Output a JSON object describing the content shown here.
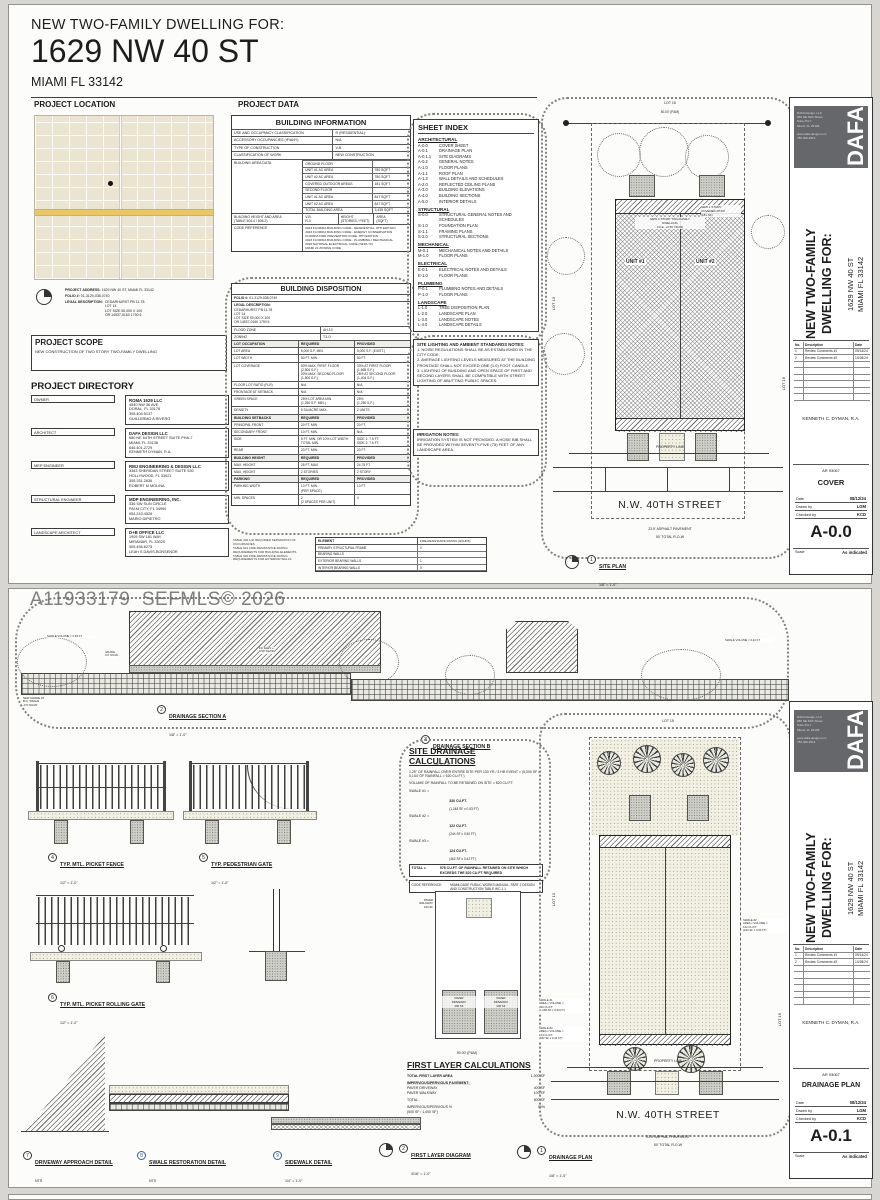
{
  "watermark": "A11933179  SEFMLS© 2026",
  "page1": {
    "header": {
      "small": "NEW TWO-FAMILY DWELLING FOR:",
      "big": "1629 NW 40 ST",
      "city": "MIAMI FL 33142"
    },
    "section_location": "PROJECT LOCATION",
    "section_data": "PROJECT DATA",
    "map_notes": {
      "address_label": "PROJECT ADDRESS:",
      "address": "1629 NW 40 ST, MIAMI FL 33142",
      "folio_label": "FOLIO #:",
      "folio": "01-3129-038-0740",
      "legal_label": "LEGAL DESCRIPTION:",
      "legal": "CEDARHURST PB 11-78\nLOT 14\nLOT SIZE 50.000 X 100\nOR 14937-0160 1790 5"
    },
    "scope": {
      "title": "PROJECT SCOPE",
      "text": "NEW CONSTRUCTION OF TWO STORY TWO-FAMILY DWELLING"
    },
    "directory_title": "PROJECT DIRECTORY",
    "directory": [
      {
        "role": "OWNER",
        "name": "ROMA 1629 LLC",
        "info": "4540 NW 36 AVE\nDORAL, FL 33178\n305.404.5137\nGUILLERMO A RIVERO"
      },
      {
        "role": "ARCHITECT",
        "name": "DAFA DESIGN LLC",
        "info": "680 NE 64TH STREET SUITE PHA-7\nMIAMI, FL 33138\n646.401.2729\nKENNETH DYMAN, R.A."
      },
      {
        "role": "MEP ENGINEER",
        "name": "RMJ ENGINEERING & DESIGN LLC",
        "info": "3363 SHERIDAN STREET SUITE 530\nHOLLYWOOD, FL 33021\n305.331.2636\nROBERT M MOLINA"
      },
      {
        "role": "STRUCTURAL ENGINEER",
        "name": "MDP ENGINEERING, INC.",
        "info": "336 SW SUN CIRCLE\nPALM CITY, FL 34990\n954.243.4526\nMARIO DIPIETRO"
      },
      {
        "role": "LANDSCAPE ARCHITECT",
        "name": "D+B OFFICE LLC",
        "info": "1905 SW 181 WAY\nMIRAMAR, FL 33029\n305.456.6275\nLEAH S DAVIS-BONSENOR"
      }
    ],
    "building_info": {
      "title": "BUILDING INFORMATION",
      "rows": [
        {
          "label": "USE AND OCCUPANCY CLASSIFICATION",
          "value": "R (RESIDENTIAL)"
        },
        {
          "label": "ACCESSORY OCCUPANCIES (IF/ANY)",
          "value": "N/A"
        },
        {
          "label": "TYPE OF CONSTRUCTION",
          "value": "V-B"
        },
        {
          "label": "CLASSIFICATION OF WORK",
          "value": "NEW CONSTRUCTION"
        }
      ],
      "area_label": "BUILDING AREA DATA",
      "area_rows": [
        {
          "name": "GROUND FLOOR",
          "sqft": ""
        },
        {
          "name": "UNIT #1 AC AREA",
          "sqft": "780 SQFT"
        },
        {
          "name": "UNIT #2 AC AREA",
          "sqft": "780 SQFT"
        },
        {
          "name": "COVERED OUTDOOR AREAS",
          "sqft": "181 SQFT"
        },
        {
          "name": "SECOND FLOOR",
          "sqft": ""
        },
        {
          "name": "UNIT #1 AC AREA",
          "sqft": "847 SQFT"
        },
        {
          "name": "UNIT #2 AC AREA",
          "sqft": "847 SQFT"
        },
        {
          "name": "TOTAL BUILDING AREA",
          "sqft": "3,435 SQFT"
        }
      ],
      "height_row": {
        "label": "BUILDING HEIGHT AND AREA\n(TABLE 504.4 / 506.2)",
        "c1": "V-B\nR-3",
        "c2": "HEIGHT\n(STORIES / FEET)",
        "c3": "AREA\n(SQFT)"
      },
      "code_row": {
        "label": "CODE REFERENCE",
        "value": "2023 FLORIDA BUILDING CODE - RESIDENTIAL, 8TH EDITION\n2023 FLORIDA BUILDING CODE - ENERGY CONSERVATION\nFLORIDA FIRE PREVENTION CODE, 8TH EDITION\n2023 FLORIDA BUILDING CODE - PLUMBING / MECHANICAL\n2020 NATIONAL ELECTRICAL CODE (NFPA 70)\nMIAMI 21 ZONING CODE"
      }
    },
    "fire_notes": "TABLE 302.1(1) REQUIRED SEPARATION OF OCCUPANCIES\nTABLE 601 FIRE-RESISTANCE RATING REQUIREMENTS FOR BUILDING ELEMENTS\nTABLE 602 FIRE-RESISTANCE RATING REQUIREMENTS FOR EXTERIOR WALLS",
    "fire_table": {
      "title": "ELEMENT",
      "col": "FIRE-RESISTANCE RATING (HOURS)",
      "rows": [
        [
          "PRIMARY STRUCTURAL FRAME",
          "0"
        ],
        [
          "BEARING WALLS",
          ""
        ],
        [
          "EXTERIOR BEARING WALLS",
          "1"
        ],
        [
          "INTERIOR BEARING WALLS",
          "0"
        ]
      ]
    },
    "disposition": {
      "title": "BUILDING DISPOSITION",
      "folio_label": "FOLIO #:",
      "folio": "01-3129-038-0740",
      "legal_label": "LEGAL DESCRIPTION:",
      "legal": "CEDARHURST PB 11-78\nLOT 14\nLOT SIZE 50.000 X 100\nOR 14937-0160 1790 5",
      "flood_label": "FLOOD ZONE",
      "flood": "AH-10",
      "zoning_label": "ZONING",
      "zoning": "T3-O",
      "occ_header": {
        "a": "LOT OCCUPATION",
        "b": "REQUIRED",
        "c": "PROVIDED"
      },
      "occ_rows": [
        {
          "a": "LOT AREA",
          "b": "5,000 S.F. MIN.",
          "c": "5,000 S.F. (EXIST.)"
        },
        {
          "a": "LOT WIDTH",
          "b": "50 FT. MIN.",
          "c": "50 FT."
        },
        {
          "a": "LOT COVERAGE",
          "b": "50% MAX. FIRST FLOOR\n(2,500 S.F.)\n30% MAX. SECOND FLOOR\n(1,500 S.F.)",
          "c": "33% AT FIRST FLOOR\n(1,665 S.F.)\n28% AT SECOND FLOOR\n(1,404 S.F.)"
        },
        {
          "a": "FLOOR LOT RATIO (FLR)",
          "b": "N/A",
          "c": "N/A"
        },
        {
          "a": "FRONTAGE AT SETBACK",
          "b": "N/A",
          "c": "N/A"
        },
        {
          "a": "GREEN SPACE",
          "b": "25% LOT AREA MIN.\n(1,250 S.F. MIN.)",
          "c": "25%\n(1,250 S.F.)"
        },
        {
          "a": "DENSITY",
          "b": "9 DU/ACRE MAX.",
          "c": "2 UNITS"
        }
      ],
      "set_header": {
        "a": "BUILDING SETBACKS",
        "b": "REQUIRED",
        "c": "PROVIDED"
      },
      "set_rows": [
        {
          "a": "PRINCIPAL FRONT",
          "b": "20 FT. MIN.",
          "c": "20 FT."
        },
        {
          "a": "SECONDARY FRONT",
          "b": "10 FT. MIN.",
          "c": "N/A"
        },
        {
          "a": "SIDE",
          "b": "5 FT. MIN. OR 10% LOT WIDTH\nTOTAL MIN.",
          "c": "SIDE 1: 7.5 FT.\nSIDE 2: 7.5 FT."
        },
        {
          "a": "REAR",
          "b": "20 FT. MIN.",
          "c": "20 FT."
        }
      ],
      "hgt_header": {
        "a": "BUILDING HEIGHT",
        "b": "REQUIRED",
        "c": "PROVIDED"
      },
      "hgt_rows": [
        {
          "a": "MAX. HEIGHT",
          "b": "25 FT. MAX.",
          "c": "24.75 FT."
        },
        {
          "a": "MAX. HEIGHT",
          "b": "2 STORIES",
          "c": "2 STORY"
        }
      ],
      "park_header": {
        "a": "PARKING",
        "b": "REQUIRED",
        "c": "PROVIDED"
      },
      "park_rows": [
        {
          "a": "PARKING WIDTH",
          "b": "10 FT. MIN.\n(PER SPACE)",
          "c": "10 FT."
        },
        {
          "a": "MIN. SPACES",
          "b": "2\n(2 SPACES PER UNIT)",
          "c": "4"
        }
      ]
    },
    "sheet_index": {
      "title": "SHEET INDEX",
      "arch_label": "ARCHITECTURAL",
      "arch": [
        [
          "A-0.0",
          "COVER SHEET"
        ],
        [
          "A-0.1",
          "DRAINAGE PLAN"
        ],
        [
          "A-0.1.1",
          "SITE DIAGRAMS"
        ],
        [
          "A-0.2",
          "GENERAL NOTES"
        ],
        [
          "A-1.0",
          "FLOOR PLANS"
        ],
        [
          "A-1.1",
          "ROOF PLAN"
        ],
        [
          "A-1.2",
          "WALL DETAILS AND SCHEDULES"
        ],
        [
          "A-2.0",
          "REFLECTED CEILING PLANS"
        ],
        [
          "A-3.0",
          "BUILDING ELEVATIONS"
        ],
        [
          "A-4.0",
          "BUILDING SECTIONS"
        ],
        [
          "A-5.0",
          "INTERIOR DETAILS"
        ]
      ],
      "str_label": "STRUCTURAL",
      "str": [
        [
          "S-0.0",
          "STRUCTURAL GENERAL NOTES AND SCHEDULES"
        ],
        [
          "S-1.0",
          "FOUNDATION PLAN"
        ],
        [
          "S-1.1",
          "FRAMING PLANS"
        ],
        [
          "S-2.0",
          "STRUCTURAL SECTIONS"
        ]
      ],
      "mec_label": "MECHANICAL",
      "mec": [
        [
          "M-0.1",
          "MECHANICAL NOTES AND DETAILS"
        ],
        [
          "M-1.0",
          "FLOOR PLANS"
        ]
      ],
      "ele_label": "ELECTRICAL",
      "ele": [
        [
          "E-0.1",
          "ELECTRICAL NOTES AND DETAILS"
        ],
        [
          "E-1.0",
          "FLOOR PLANS"
        ]
      ],
      "plu_label": "PLUMBING",
      "plu": [
        [
          "P-0.1",
          "PLUMBING NOTES AND DETAILS"
        ],
        [
          "P-1.0",
          "FLOOR PLANS"
        ]
      ],
      "lan_label": "LANDSCAPE",
      "lan": [
        [
          "L-1.0",
          "TREE DISPOSITION PLAN"
        ],
        [
          "L-2.0",
          "LANDSCAPE PLAN"
        ],
        [
          "L-3.0",
          "LANDSCAPE NOTES"
        ],
        [
          "L-4.0",
          "LANDSCAPE DETAILS"
        ]
      ]
    },
    "lighting": {
      "title": "SITE LIGHTING AND AMBIENT STANDARDS NOTES:",
      "body": "1. NOISE REGULATIONS SHALL BE AS ESTABLISHED IN THE CITY CODE.\n2. AVERAGE LIGHTING LEVELS MEASURED AT THE BUILDING FRONTAGE SHALL NOT EXCEED ONE (1.0) FOOT CANDLE.\n3. LIGHTING OF BUILDING AND OPEN SPACE OF FIRST AND SECOND LAYERS SHALL BE COMPATIBLE WITH STREET LIGHTING OF ABUTTING PUBLIC SPACES."
    },
    "irrigation": {
      "title": "IRRIGATION NOTES:",
      "body": "IRRIGATION SYSTEM IS NOT PROVIDED. A HOSE BIB SHALL BE PROVIDED WITHIN SEVENTY-FIVE (75) FEET OF ANY LANDSCAPE AREA."
    },
    "site_plan": {
      "lot_top": "LOT 15",
      "lot_left": "LOT 13",
      "lot_right": "LOT 16",
      "dim_top": "50.00' (P&M)",
      "unit1": "UNIT #1",
      "unit2": "UNIT #2",
      "center_note": "NEW 2 STORY TWO-FAMILY\nDWELLING\nF.F.E. +0.50' NGVD",
      "patio_note": "NEW 1 STORY\nCOVERED PATIO\n(181 SF)",
      "property_line": "PROPERTY LINE",
      "street": "N.W. 40TH STREET",
      "pavement": "23.5' ASPHALT PAVEMENT",
      "row": "50' TOTAL R-O-W",
      "detail_num": "1",
      "detail_name": "SITE PLAN",
      "detail_scale": "1/8\" = 1'-0\""
    },
    "titleblock": {
      "firm": "DAFA Design, LLC\n680 NE 64th Street\nSuite PH-7\nMiami, FL 33138\n\nwww.dafa-design.com\n786.409.2513",
      "logo": "DAFA",
      "proj_line1": "NEW TWO-FAMILY",
      "proj_line2": "DWELLING FOR:",
      "addr_line1": "1629 NW 40 ST",
      "addr_line2": "MIAMI FL 33142",
      "rev_no": "No.",
      "rev_desc": "Description",
      "rev_date": "Date",
      "revisions": [
        {
          "no": "1",
          "desc": "Review Comments #1",
          "date": "09/14/24"
        },
        {
          "no": "2",
          "desc": "Review Comments #2",
          "date": "10/28/24"
        }
      ],
      "architect": "KENNETH C. DYMAN, R.A.",
      "license": "AR 93067",
      "sheet_title": "COVER",
      "date_label": "Date",
      "date": "08/12/24",
      "drawn_label": "Drawn by",
      "drawn": "LGM",
      "checked_label": "Checked by",
      "checked": "KCD",
      "sheet_num": "A-0.0",
      "scale_label": "Scale",
      "scale": "As indicated"
    }
  },
  "page2": {
    "sections": {
      "a_num": "2",
      "a_name": "DRAINAGE SECTION A",
      "a_scale": "1/8\" = 1'-0\"",
      "b_num": "3",
      "b_name": "DRAINAGE SECTION B",
      "b_scale": "1/8\" = 1'-0\"",
      "c1": "SWALE VOLUME = 0.53 FT",
      "c2": "GRADE\n0.0' NGVD",
      "c3": "F.F. ELEV +\n0.50' NGVD",
      "c4": "NEW GRADE AT\nB.O. SWALE\n-0.5' NGVD",
      "c5": "SWALE VOLUME = 0.42 FT"
    },
    "fence": {
      "num": "4",
      "name": "TYP. MTL. PICKET FENCE",
      "scale": "1/2\" = 1'-0\""
    },
    "gate": {
      "num": "5",
      "name": "TYP. PEDESTRIAN GATE",
      "scale": "1/2\" = 1'-0\""
    },
    "rolling": {
      "num": "6",
      "name": "TYP. MTL. PICKET ROLLING GATE",
      "scale": "1/2\" = 1'-0\""
    },
    "drainage_calc": {
      "title": "SITE DRAINAGE CALCULATIONS",
      "intro": "1.25\" OF RAINFALL OVER ENTIRE SITE PER 100 YR / 3 HR EVENT = (5,000 SF x 0.104' OF RAINFALL = 520 CU.FT.)",
      "volume": "VOLUME OF RAINFALL TO BE RETAINED ON SITE = 520 CU.FT.",
      "rows": [
        {
          "label": "SWALE #1 =",
          "v": "330 CU.FT.",
          "sub": "(1,248 SF x 0.53 FT)"
        },
        {
          "label": "SWALE #2 =",
          "v": "122 CU.FT.",
          "sub": "(244 SF x 0.50 FT)"
        },
        {
          "label": "SWALE #3 =",
          "v": "124 CU.FT.",
          "sub": "(462 SF x 0.42 FT)"
        }
      ],
      "total_label": "TOTAL =",
      "total": "576 CU.FT. OF RAINFALL RETAINED ON SITE WHICH EXCEEDS THE 520 CU.FT REQUIRED",
      "code_label": "CODE REFERENCE:",
      "code_val": "MIAMI-DADE PUBLIC WORKS MANUAL, PART 2 DESIGN AND CONSTRUCTION TABLE WC-1.1"
    },
    "first_layer": {
      "title": "FIRST LAYER CALCULATIONS",
      "total_area_label": "TOTAL FIRST LAYER AREA",
      "total_area": "1,000 SF",
      "imp_header": "I̲M̲P̲E̲R̲V̲I̲O̲U̲S̲/̲P̲E̲R̲V̲I̲O̲U̲S̲ ̲P̲A̲V̲E̲M̲E̲N̲T̲:̲",
      "rows": [
        {
          "label": "PAVER DRIVEWAY",
          "v": "400 SF"
        },
        {
          "label": "PAVER WALKWAY",
          "v": "100 SF"
        }
      ],
      "total_label": "TOTAL",
      "total": "500 SF",
      "pct_label": "IMPERVIOUS/PERVIOUS %\n(500 SF / 1,000 SF)",
      "pct": "50%"
    },
    "diagram": {
      "dim": "50.00' (P&M)",
      "walkway": "PAVER\nWALKWAY\n100 SF",
      "driveway1": "PAVER\nDRIVEWAY\n200 SF",
      "driveway2": "PAVER\nDRIVEWAY\n200 SF"
    },
    "plan": {
      "lot_top": "LOT 15",
      "lot_left": "LOT 13",
      "lot_right": "LOT 16",
      "swale1": "SWALE #1\nAREA x VOLUME =\n330 CU.FT.\n(1,248 SF x 0.53 FT)",
      "swale2": "SWALE #2\nAREA x VOLUME =\n122 CU.FT.\n(244 SF x 0.50 FT)",
      "swale3": "SWALE #3\nAREA x VOLUME =\n124 CU.FT.\n(462 SF x 0.42 FT)",
      "property_line": "PROPERTY LINE",
      "street": "N.W. 40TH STREET",
      "pavement": "23.5' ASPHALT PAVEMENT",
      "row": "50' TOTAL R-O-W"
    },
    "details": {
      "driveway": {
        "num": "7",
        "name": "DRIVEWAY APPROACH DETAIL",
        "scale": "NTS"
      },
      "swale_rest": {
        "num": "8",
        "name": "SWALE RESTORATION DETAIL",
        "scale": "NTS"
      },
      "sidewalk": {
        "num": "9",
        "name": "SIDEWALK DETAIL",
        "scale": "1/4\" = 1'-0\""
      },
      "first_layer": {
        "num": "2",
        "name": "FIRST LAYER DIAGRAM",
        "scale": "3/16\" = 1'-0\""
      },
      "plan": {
        "num": "1",
        "name": "DRAINAGE PLAN",
        "scale": "1/8\" = 1'-0\""
      }
    },
    "titleblock": {
      "sheet_title": "DRAINAGE PLAN",
      "sheet_num": "A-0.1"
    }
  }
}
